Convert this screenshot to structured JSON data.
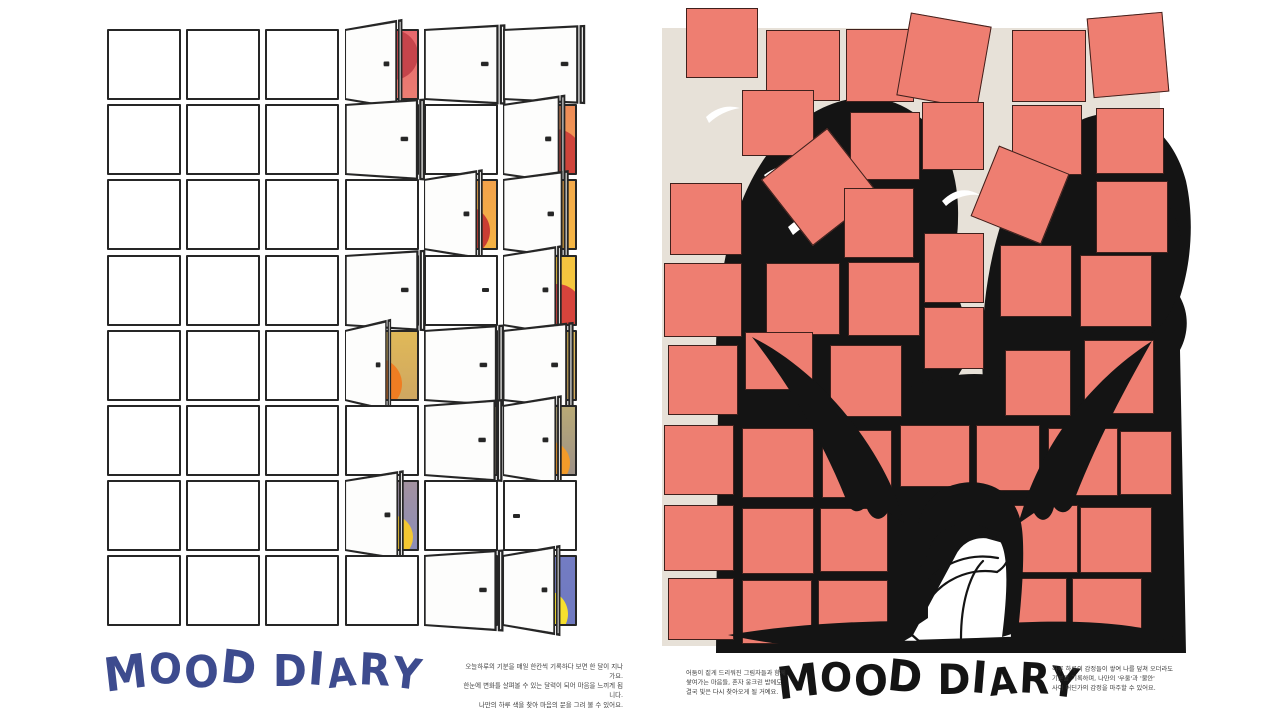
{
  "palette": {
    "ink": "#141414",
    "line": "#262626",
    "salmon": "#ee7e71",
    "beige": "#e7e1d8",
    "navy": "#3d4b8e",
    "paper": "#ffffff"
  },
  "left_poster": {
    "title": "MOOD DIARY",
    "title_color": "#3d4b8e",
    "caption": "오늘하루의 기분을 매일 한칸씩 기록하다 보면 한 달이 지나가요.\n한눈에 변화를 살펴볼 수 있는 달력이 되어 마음을 느끼게 됩니다.\n나만의 하루 색을 찾아 마음의 문을 그려 볼 수 있어요.",
    "grid": {
      "rows": 8,
      "cols": 6,
      "pitch_x": 79.2,
      "pitch_y": 75.2,
      "cell_w": 74,
      "cell_h": 71
    },
    "open_cells": [
      {
        "r": 0,
        "c": 3,
        "angle": 56,
        "grad": [
          "#e8686d",
          "#eb7d72"
        ],
        "sun": {
          "x": 0.66,
          "y": 0.36,
          "r": 25,
          "color": "#c5444b"
        }
      },
      {
        "r": 0,
        "c": 4,
        "angle": 26,
        "grad": [
          "#e8686d",
          "#eb7d72"
        ],
        "sun": null
      },
      {
        "r": 0,
        "c": 5,
        "angle": 23,
        "grad": [
          "#e8686d",
          "#eb7d72"
        ],
        "sun": null
      },
      {
        "r": 1,
        "c": 3,
        "angle": 30,
        "grad": [
          "#ee8b58",
          "#f2a250"
        ],
        "sun": null
      },
      {
        "r": 1,
        "c": 5,
        "angle": 52,
        "grad": [
          "#ee8b58",
          "#f2a250"
        ],
        "sun": {
          "x": 0.72,
          "y": 0.74,
          "r": 27,
          "color": "#cf443b"
        }
      },
      {
        "r": 2,
        "c": 4,
        "angle": 55,
        "grad": [
          "#f2a24b",
          "#f4b244"
        ],
        "sun": {
          "x": 0.56,
          "y": 0.74,
          "r": 25,
          "color": "#c93d33"
        }
      },
      {
        "r": 2,
        "c": 5,
        "angle": 49,
        "grad": [
          "#f3a94a",
          "#f4b644"
        ],
        "sun": null
      },
      {
        "r": 3,
        "c": 3,
        "angle": 29,
        "grad": [
          "#f4c340",
          "#f5cc3b"
        ],
        "sun": null
      },
      {
        "r": 3,
        "c": 5,
        "angle": 55,
        "grad": [
          "#f4c340",
          "#f5cc3b"
        ],
        "sun": {
          "x": 0.74,
          "y": 0.78,
          "r": 25,
          "color": "#d6443c"
        }
      },
      {
        "r": 4,
        "c": 3,
        "angle": 64,
        "grad": [
          "#e0b958",
          "#cfa761"
        ],
        "sun": {
          "x": 0.42,
          "y": 0.78,
          "r": 26,
          "color": "#ef7d22"
        }
      },
      {
        "r": 4,
        "c": 4,
        "angle": 30,
        "grad": [
          "#e6c04e",
          "#d9b257"
        ],
        "sun": null
      },
      {
        "r": 4,
        "c": 5,
        "angle": 44,
        "grad": [
          "#e2bb54",
          "#cfa95f"
        ],
        "sun": null
      },
      {
        "r": 5,
        "c": 4,
        "angle": 33,
        "grad": [
          "#b5a674",
          "#a09580"
        ],
        "sun": null
      },
      {
        "r": 5,
        "c": 5,
        "angle": 55,
        "grad": [
          "#b9aa76",
          "#9d9187"
        ],
        "sun": {
          "x": 0.62,
          "y": 0.84,
          "r": 22,
          "color": "#f29b2a"
        }
      },
      {
        "r": 6,
        "c": 3,
        "angle": 55,
        "grad": [
          "#a392a0",
          "#8a8cb8"
        ],
        "sun": {
          "x": 0.63,
          "y": 0.82,
          "r": 22,
          "color": "#f4c832"
        }
      },
      {
        "r": 7,
        "c": 4,
        "angle": 31,
        "grad": [
          "#737cc3",
          "#6f79c0"
        ],
        "sun": null
      },
      {
        "r": 7,
        "c": 5,
        "angle": 56,
        "grad": [
          "#737cc3",
          "#6f79c0"
        ],
        "sun": {
          "x": 0.56,
          "y": 0.84,
          "r": 24,
          "color": "#f6df2e"
        }
      }
    ],
    "handle_cells": [
      {
        "r": 3,
        "c": 4,
        "side": "right"
      },
      {
        "r": 6,
        "c": 5,
        "side": "left"
      }
    ]
  },
  "right_poster": {
    "title": "MOOD DIARY",
    "title_color": "#141414",
    "caption_left": "어둠이 짙게 드리워진 그림자들과 함께\n쌓여가는 마음들, 혼자 웅크린 밤에도\n결국 빛은 다시 찾아오게 될 거예요.",
    "caption_right": "하루 하루의 감정들이 쌓여 나를 덮쳐 오더라도\n기분을 기록하며, 나만의 '우울'과 '불안'\n사이 어딘가의 감정을 마주할 수 있어요.",
    "square_color": "#ee7e71",
    "panel_color": "#e7e1d8",
    "squares": [
      {
        "x": 26,
        "y": 3,
        "w": 72,
        "h": 70,
        "rot": 0
      },
      {
        "x": 106,
        "y": 25,
        "w": 74,
        "h": 71,
        "rot": 0
      },
      {
        "x": 186,
        "y": 24,
        "w": 68,
        "h": 73,
        "rot": 0
      },
      {
        "x": 243,
        "y": 14,
        "w": 82,
        "h": 84,
        "rot": 10
      },
      {
        "x": 352,
        "y": 25,
        "w": 74,
        "h": 72,
        "rot": 0
      },
      {
        "x": 430,
        "y": 10,
        "w": 76,
        "h": 80,
        "rot": -5
      },
      {
        "x": 82,
        "y": 85,
        "w": 72,
        "h": 66,
        "rot": 0
      },
      {
        "x": 190,
        "y": 107,
        "w": 70,
        "h": 68,
        "rot": 0
      },
      {
        "x": 262,
        "y": 97,
        "w": 62,
        "h": 68,
        "rot": 0
      },
      {
        "x": 352,
        "y": 100,
        "w": 70,
        "h": 70,
        "rot": 0
      },
      {
        "x": 436,
        "y": 103,
        "w": 68,
        "h": 66,
        "rot": 0
      },
      {
        "x": 10,
        "y": 178,
        "w": 72,
        "h": 72,
        "rot": 0
      },
      {
        "x": 118,
        "y": 140,
        "w": 84,
        "h": 84,
        "rot": -38
      },
      {
        "x": 184,
        "y": 183,
        "w": 70,
        "h": 70,
        "rot": 0
      },
      {
        "x": 322,
        "y": 152,
        "w": 76,
        "h": 76,
        "rot": 22
      },
      {
        "x": 436,
        "y": 176,
        "w": 72,
        "h": 72,
        "rot": 0
      },
      {
        "x": 4,
        "y": 258,
        "w": 78,
        "h": 74,
        "rot": 0
      },
      {
        "x": 106,
        "y": 258,
        "w": 74,
        "h": 72,
        "rot": 0
      },
      {
        "x": 188,
        "y": 257,
        "w": 72,
        "h": 74,
        "rot": 0
      },
      {
        "x": 264,
        "y": 228,
        "w": 60,
        "h": 70,
        "rot": 0
      },
      {
        "x": 340,
        "y": 240,
        "w": 72,
        "h": 72,
        "rot": 0
      },
      {
        "x": 420,
        "y": 250,
        "w": 72,
        "h": 72,
        "rot": 0
      },
      {
        "x": 8,
        "y": 340,
        "w": 70,
        "h": 70,
        "rot": 0
      },
      {
        "x": 85,
        "y": 327,
        "w": 68,
        "h": 58,
        "rot": 0
      },
      {
        "x": 170,
        "y": 340,
        "w": 72,
        "h": 72,
        "rot": 0
      },
      {
        "x": 264,
        "y": 302,
        "w": 60,
        "h": 62,
        "rot": 0
      },
      {
        "x": 345,
        "y": 345,
        "w": 66,
        "h": 66,
        "rot": 0
      },
      {
        "x": 424,
        "y": 335,
        "w": 70,
        "h": 74,
        "rot": 0
      },
      {
        "x": 4,
        "y": 420,
        "w": 70,
        "h": 70,
        "rot": 0
      },
      {
        "x": 82,
        "y": 423,
        "w": 72,
        "h": 70,
        "rot": 0
      },
      {
        "x": 162,
        "y": 425,
        "w": 70,
        "h": 68,
        "rot": 0
      },
      {
        "x": 240,
        "y": 420,
        "w": 70,
        "h": 62,
        "rot": 0
      },
      {
        "x": 316,
        "y": 420,
        "w": 64,
        "h": 66,
        "rot": 0
      },
      {
        "x": 388,
        "y": 423,
        "w": 70,
        "h": 68,
        "rot": 0
      },
      {
        "x": 460,
        "y": 426,
        "w": 52,
        "h": 64,
        "rot": 0
      },
      {
        "x": 4,
        "y": 500,
        "w": 70,
        "h": 66,
        "rot": 0
      },
      {
        "x": 82,
        "y": 503,
        "w": 72,
        "h": 66,
        "rot": 0
      },
      {
        "x": 160,
        "y": 503,
        "w": 68,
        "h": 64,
        "rot": 0
      },
      {
        "x": 348,
        "y": 500,
        "w": 70,
        "h": 68,
        "rot": 0
      },
      {
        "x": 420,
        "y": 502,
        "w": 72,
        "h": 66,
        "rot": 0
      },
      {
        "x": 8,
        "y": 573,
        "w": 66,
        "h": 62,
        "rot": 0
      },
      {
        "x": 82,
        "y": 575,
        "w": 70,
        "h": 64,
        "rot": 0
      },
      {
        "x": 158,
        "y": 575,
        "w": 70,
        "h": 62,
        "rot": 0
      },
      {
        "x": 335,
        "y": 573,
        "w": 72,
        "h": 64,
        "rot": 0
      },
      {
        "x": 412,
        "y": 573,
        "w": 70,
        "h": 64,
        "rot": 0
      }
    ]
  }
}
